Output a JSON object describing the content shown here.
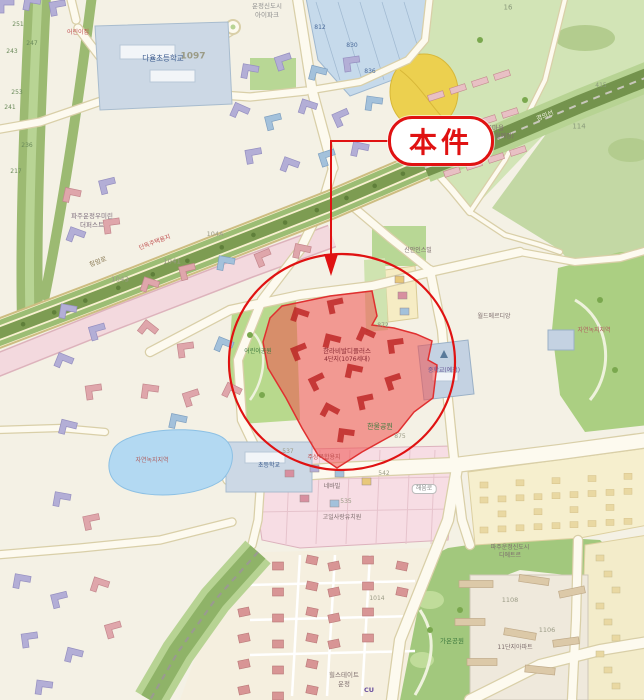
{
  "annotation": {
    "callout_label": "本件",
    "accent_color": "#e01212",
    "parcel_fill": "#f0504e",
    "parcel_opacity": 0.55
  },
  "map": {
    "labels": [
      {
        "t": "다율초등학교",
        "x": 163,
        "y": 58,
        "s": 7.5,
        "c": "#38588c"
      },
      {
        "t": "운정신도시",
        "x": 267,
        "y": 6,
        "s": 6.5,
        "c": "#8f8f8f"
      },
      {
        "t": "아이파크",
        "x": 267,
        "y": 15,
        "s": 6.5,
        "c": "#8f8f8f"
      },
      {
        "t": "1097",
        "x": 193,
        "y": 57,
        "s": 9,
        "c": "#9b9b86",
        "b": 1
      },
      {
        "t": "초롱꽃마을",
        "x": 489,
        "y": 128,
        "s": 6.5,
        "c": "#7d6d6d"
      },
      {
        "t": "(2024년11월예정)",
        "x": 489,
        "y": 137,
        "s": 6,
        "c": "#7d6d6d"
      },
      {
        "t": "파주운정우미린",
        "x": 92,
        "y": 216,
        "s": 6.5,
        "c": "#7d6d7d"
      },
      {
        "t": "더퍼스트",
        "x": 92,
        "y": 225,
        "s": 6.5,
        "c": "#7d6d7d"
      },
      {
        "t": "812",
        "x": 320,
        "y": 28,
        "s": 6,
        "c": "#4a6a9a"
      },
      {
        "t": "830",
        "x": 352,
        "y": 46,
        "s": 6,
        "c": "#4a6a9a"
      },
      {
        "t": "836",
        "x": 370,
        "y": 72,
        "s": 6,
        "c": "#4a6a9a"
      },
      {
        "t": "16",
        "x": 508,
        "y": 8,
        "s": 7,
        "c": "#8a9a7a"
      },
      {
        "t": "415",
        "x": 601,
        "y": 86,
        "s": 6,
        "c": "#8a9a7a"
      },
      {
        "t": "114",
        "x": 579,
        "y": 127,
        "s": 7,
        "c": "#8a9a7a"
      },
      {
        "t": "872",
        "x": 383,
        "y": 326,
        "s": 6,
        "c": "#8f8f7c"
      },
      {
        "t": "251",
        "x": 18,
        "y": 25,
        "s": 6,
        "c": "#6a8a5a"
      },
      {
        "t": "247",
        "x": 32,
        "y": 44,
        "s": 6,
        "c": "#6a8a5a"
      },
      {
        "t": "243",
        "x": 12,
        "y": 52,
        "s": 6,
        "c": "#6a8a5a"
      },
      {
        "t": "253",
        "x": 17,
        "y": 93,
        "s": 6,
        "c": "#6a8a5a"
      },
      {
        "t": "241",
        "x": 10,
        "y": 108,
        "s": 6,
        "c": "#6a8a5a"
      },
      {
        "t": "236",
        "x": 27,
        "y": 146,
        "s": 6,
        "c": "#6a8a5a"
      },
      {
        "t": "217",
        "x": 16,
        "y": 172,
        "s": 6,
        "c": "#6a8a5a"
      },
      {
        "t": "청암로",
        "x": 98,
        "y": 262,
        "s": 6.5,
        "c": "#8a7a55",
        "r": -21
      },
      {
        "t": "경의선",
        "x": 545,
        "y": 116,
        "s": 6.5,
        "c": "#eef2dc",
        "r": -22
      },
      {
        "t": "단독주택용지",
        "x": 155,
        "y": 243,
        "s": 6,
        "c": "#c05050",
        "r": -21
      },
      {
        "t": "1041",
        "x": 172,
        "y": 262,
        "s": 7,
        "c": "#9b9b86"
      },
      {
        "t": "1043",
        "x": 120,
        "y": 280,
        "s": 7,
        "c": "#9b9b86"
      },
      {
        "t": "104A",
        "x": 215,
        "y": 234,
        "s": 6.5,
        "c": "#9b9b86"
      },
      {
        "t": "어린이공원",
        "x": 258,
        "y": 352,
        "s": 6,
        "c": "#3e7a3e"
      },
      {
        "t": "한라비발디플러스",
        "x": 347,
        "y": 351,
        "s": 6.5,
        "c": "#8a2a34"
      },
      {
        "t": "4단지(1076세대)",
        "x": 347,
        "y": 360,
        "s": 6,
        "c": "#8a2a34"
      },
      {
        "t": "중학교(예정)",
        "x": 444,
        "y": 371,
        "s": 6,
        "c": "#6a5a9a"
      },
      {
        "t": "신안인스빌",
        "x": 418,
        "y": 251,
        "s": 6,
        "c": "#7d6d6d"
      },
      {
        "t": "월드메르디앙",
        "x": 494,
        "y": 317,
        "s": 6,
        "c": "#7d6d6d"
      },
      {
        "t": "한울공원",
        "x": 380,
        "y": 427,
        "s": 7,
        "c": "#3e7a3e"
      },
      {
        "t": "자연녹지지역",
        "x": 152,
        "y": 461,
        "s": 6,
        "c": "#b06060"
      },
      {
        "t": "자연녹지지역",
        "x": 594,
        "y": 331,
        "s": 6,
        "c": "#b06060"
      },
      {
        "t": "주상복합용지",
        "x": 324,
        "y": 458,
        "s": 6,
        "c": "#c05050"
      },
      {
        "t": "537",
        "x": 288,
        "y": 452,
        "s": 6,
        "c": "#9b9b86"
      },
      {
        "t": "542",
        "x": 384,
        "y": 474,
        "s": 6,
        "c": "#9b9b86"
      },
      {
        "t": "535",
        "x": 346,
        "y": 502,
        "s": 6,
        "c": "#9b9b86"
      },
      {
        "t": "875",
        "x": 400,
        "y": 437,
        "s": 6,
        "c": "#9b9b86"
      },
      {
        "t": "네바빌",
        "x": 332,
        "y": 487,
        "s": 6,
        "c": "#7d6d6d"
      },
      {
        "t": "고일사랑유치원",
        "x": 342,
        "y": 518,
        "s": 6,
        "c": "#7d6d6d"
      },
      {
        "t": "해움로",
        "x": 424,
        "y": 489,
        "s": 6,
        "c": "#8a8a8a",
        "p": 1
      },
      {
        "t": "초등학교",
        "x": 269,
        "y": 466,
        "s": 6,
        "c": "#38588c"
      },
      {
        "t": "파주운정신도시",
        "x": 510,
        "y": 548,
        "s": 6,
        "c": "#7d6d6d"
      },
      {
        "t": "디에트르",
        "x": 510,
        "y": 556,
        "s": 6,
        "c": "#7d6d6d"
      },
      {
        "t": "1108",
        "x": 510,
        "y": 600,
        "s": 6.5,
        "c": "#9b9b86"
      },
      {
        "t": "1106",
        "x": 547,
        "y": 630,
        "s": 6.5,
        "c": "#9b9b86"
      },
      {
        "t": "11단지아파트",
        "x": 515,
        "y": 648,
        "s": 6,
        "c": "#7d6d6d"
      },
      {
        "t": "힐스테이트",
        "x": 344,
        "y": 675,
        "s": 6.5,
        "c": "#7d6d6d"
      },
      {
        "t": "운정",
        "x": 344,
        "y": 684,
        "s": 6.5,
        "c": "#7d6d6d"
      },
      {
        "t": "1014",
        "x": 377,
        "y": 599,
        "s": 6,
        "c": "#9b9b86"
      },
      {
        "t": "CU",
        "x": 369,
        "y": 690,
        "s": 6.5,
        "c": "#6a4f9f",
        "b": 1
      },
      {
        "t": "가온공원",
        "x": 452,
        "y": 641,
        "s": 6.5,
        "c": "#3e7a3e"
      },
      {
        "t": "어린이집",
        "x": 78,
        "y": 33,
        "s": 6,
        "c": "#c05050"
      }
    ]
  },
  "palette": {
    "background": "#f4f1e5",
    "road_fill": "#fdfaef",
    "road_casing": "#d9cfa8",
    "major_road": "#f8f1d0",
    "green_corridor": "#9cba72",
    "park": "#abcf82",
    "hill": "#d2e4b6",
    "rail_band": "#74934d",
    "water": "#b3d9f2",
    "school": "#ccd8e5",
    "residential_pink": "#f3d9de",
    "building_pink": "#dfa6ab",
    "building_lavender": "#b3aed6",
    "building_blue": "#a3c1db",
    "commercial": "#f7dde4",
    "blue_zone": "#c6daeb",
    "field_yellow": "#ecd04f",
    "subject_red": "#f0504e",
    "annotation_red": "#e01212"
  }
}
